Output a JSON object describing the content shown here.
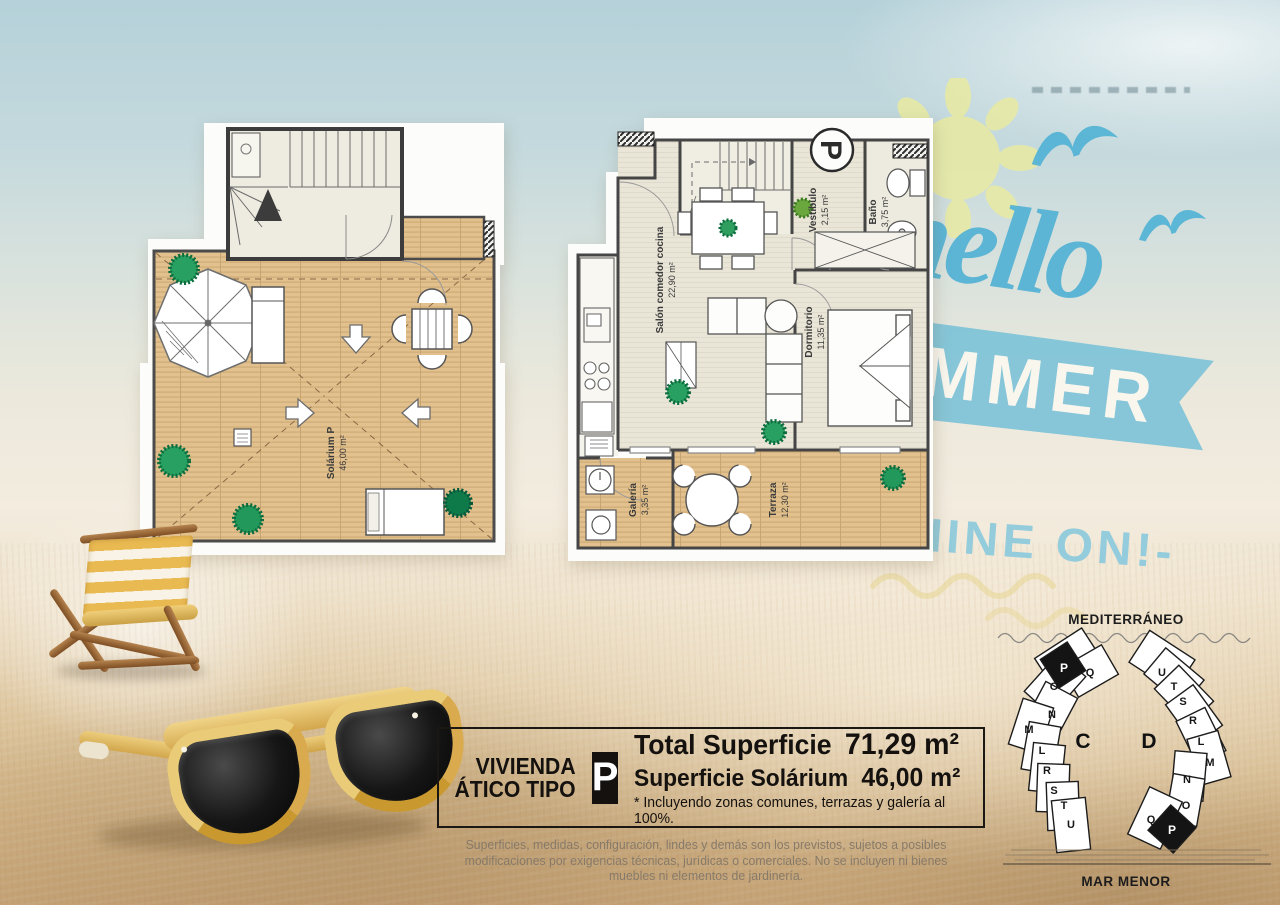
{
  "watermark": {
    "hello": "hello",
    "summer": "SUMMER",
    "shine": "SHINE ON!-",
    "accent_color": "#58b4d5"
  },
  "plans": {
    "solarium": {
      "label": "Solárium P",
      "area": "46,00 m²"
    },
    "apartment": {
      "type_letter": "P",
      "rooms": [
        {
          "name": "Salón comedor cocina",
          "area": "22,90 m²"
        },
        {
          "name": "Vestíbulo",
          "area": "2,15 m²"
        },
        {
          "name": "Baño",
          "area": "3,75 m²"
        },
        {
          "name": "Dormitorio",
          "area": "11,35 m²"
        },
        {
          "name": "Galería",
          "area": "3,35 m²"
        },
        {
          "name": "Terraza",
          "area": "12,30 m²"
        }
      ]
    }
  },
  "info_box": {
    "title_line1": "VIVIENDA",
    "title_line2": "ÁTICO TIPO",
    "type_letter": "P",
    "total_label": "Total Superficie",
    "total_value": "71,29 m²",
    "solarium_label": "Superficie Solárium",
    "solarium_value": "46,00 m²",
    "note": "* Incluyendo zonas comunes, terrazas y galería al 100%."
  },
  "disclaimer": "Superficies, medidas, configuración, lindes y demás son los previstos, sujetos a posibles modificaciones por exigencias técnicas, jurídicas o comerciales. No se incluyen ni bienes muebles ni elementos de jardinería.",
  "site_plan": {
    "sea_top": "MEDITERRÁNEO",
    "sea_bottom": "MAR MENOR",
    "building_c": {
      "label": "C",
      "units": [
        "P",
        "Q",
        "O",
        "N",
        "M",
        "L",
        "R",
        "S",
        "T",
        "U"
      ],
      "highlighted_unit": "P"
    },
    "building_d": {
      "label": "D",
      "units": [
        "U",
        "T",
        "S",
        "R",
        "L",
        "M",
        "N",
        "O",
        "Q",
        "P"
      ],
      "highlighted_unit": "P"
    }
  }
}
